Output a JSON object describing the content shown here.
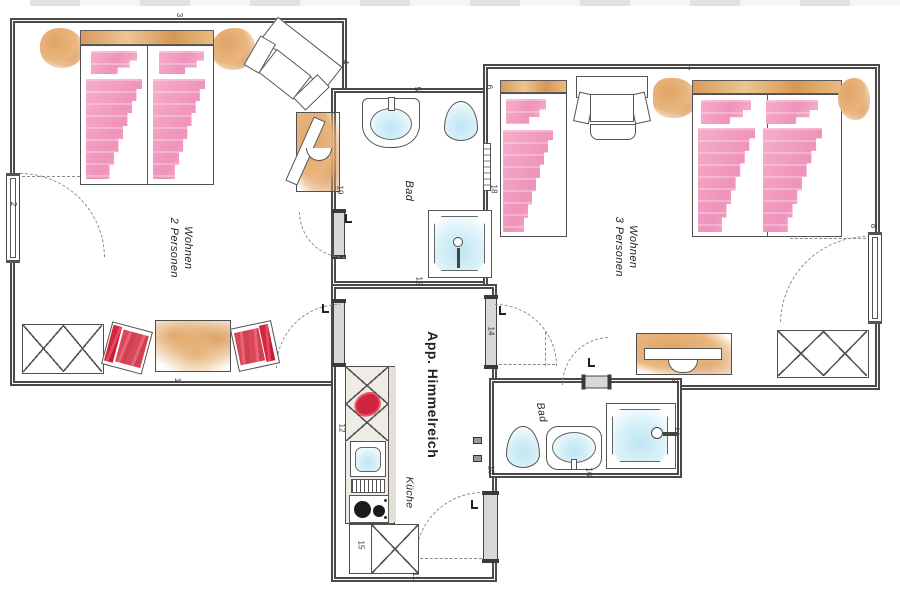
{
  "title": "App. Himmelreich",
  "rooms": {
    "wohnen2": {
      "line1": "Wohnen",
      "line2": "2 Personen"
    },
    "wohnen3": {
      "line1": "Wohnen",
      "line2": "3 Personen"
    },
    "bad_main": "Bad",
    "bad_small": "Bad",
    "kueche": "Küche"
  },
  "markers": {
    "m1": "1",
    "m2": "2",
    "m3": "3",
    "m4": "4",
    "m5": "5",
    "m6": "6",
    "m7": "7",
    "m8": "8",
    "m9": "9",
    "m10": "10",
    "m11": "11",
    "m12": "12",
    "m13": "13",
    "m14": "14",
    "m15": "15",
    "m16": "16",
    "m17": "17",
    "m18": "18",
    "m19": "19"
  },
  "colors": {
    "wall": "#4a4a4a",
    "door_fill": "#d8d8d8",
    "bed_pink": "#f3a6c4",
    "accent_red": "#d2273d",
    "wood_tan": "#dfa368",
    "water_blue": "#c5e7f3"
  }
}
